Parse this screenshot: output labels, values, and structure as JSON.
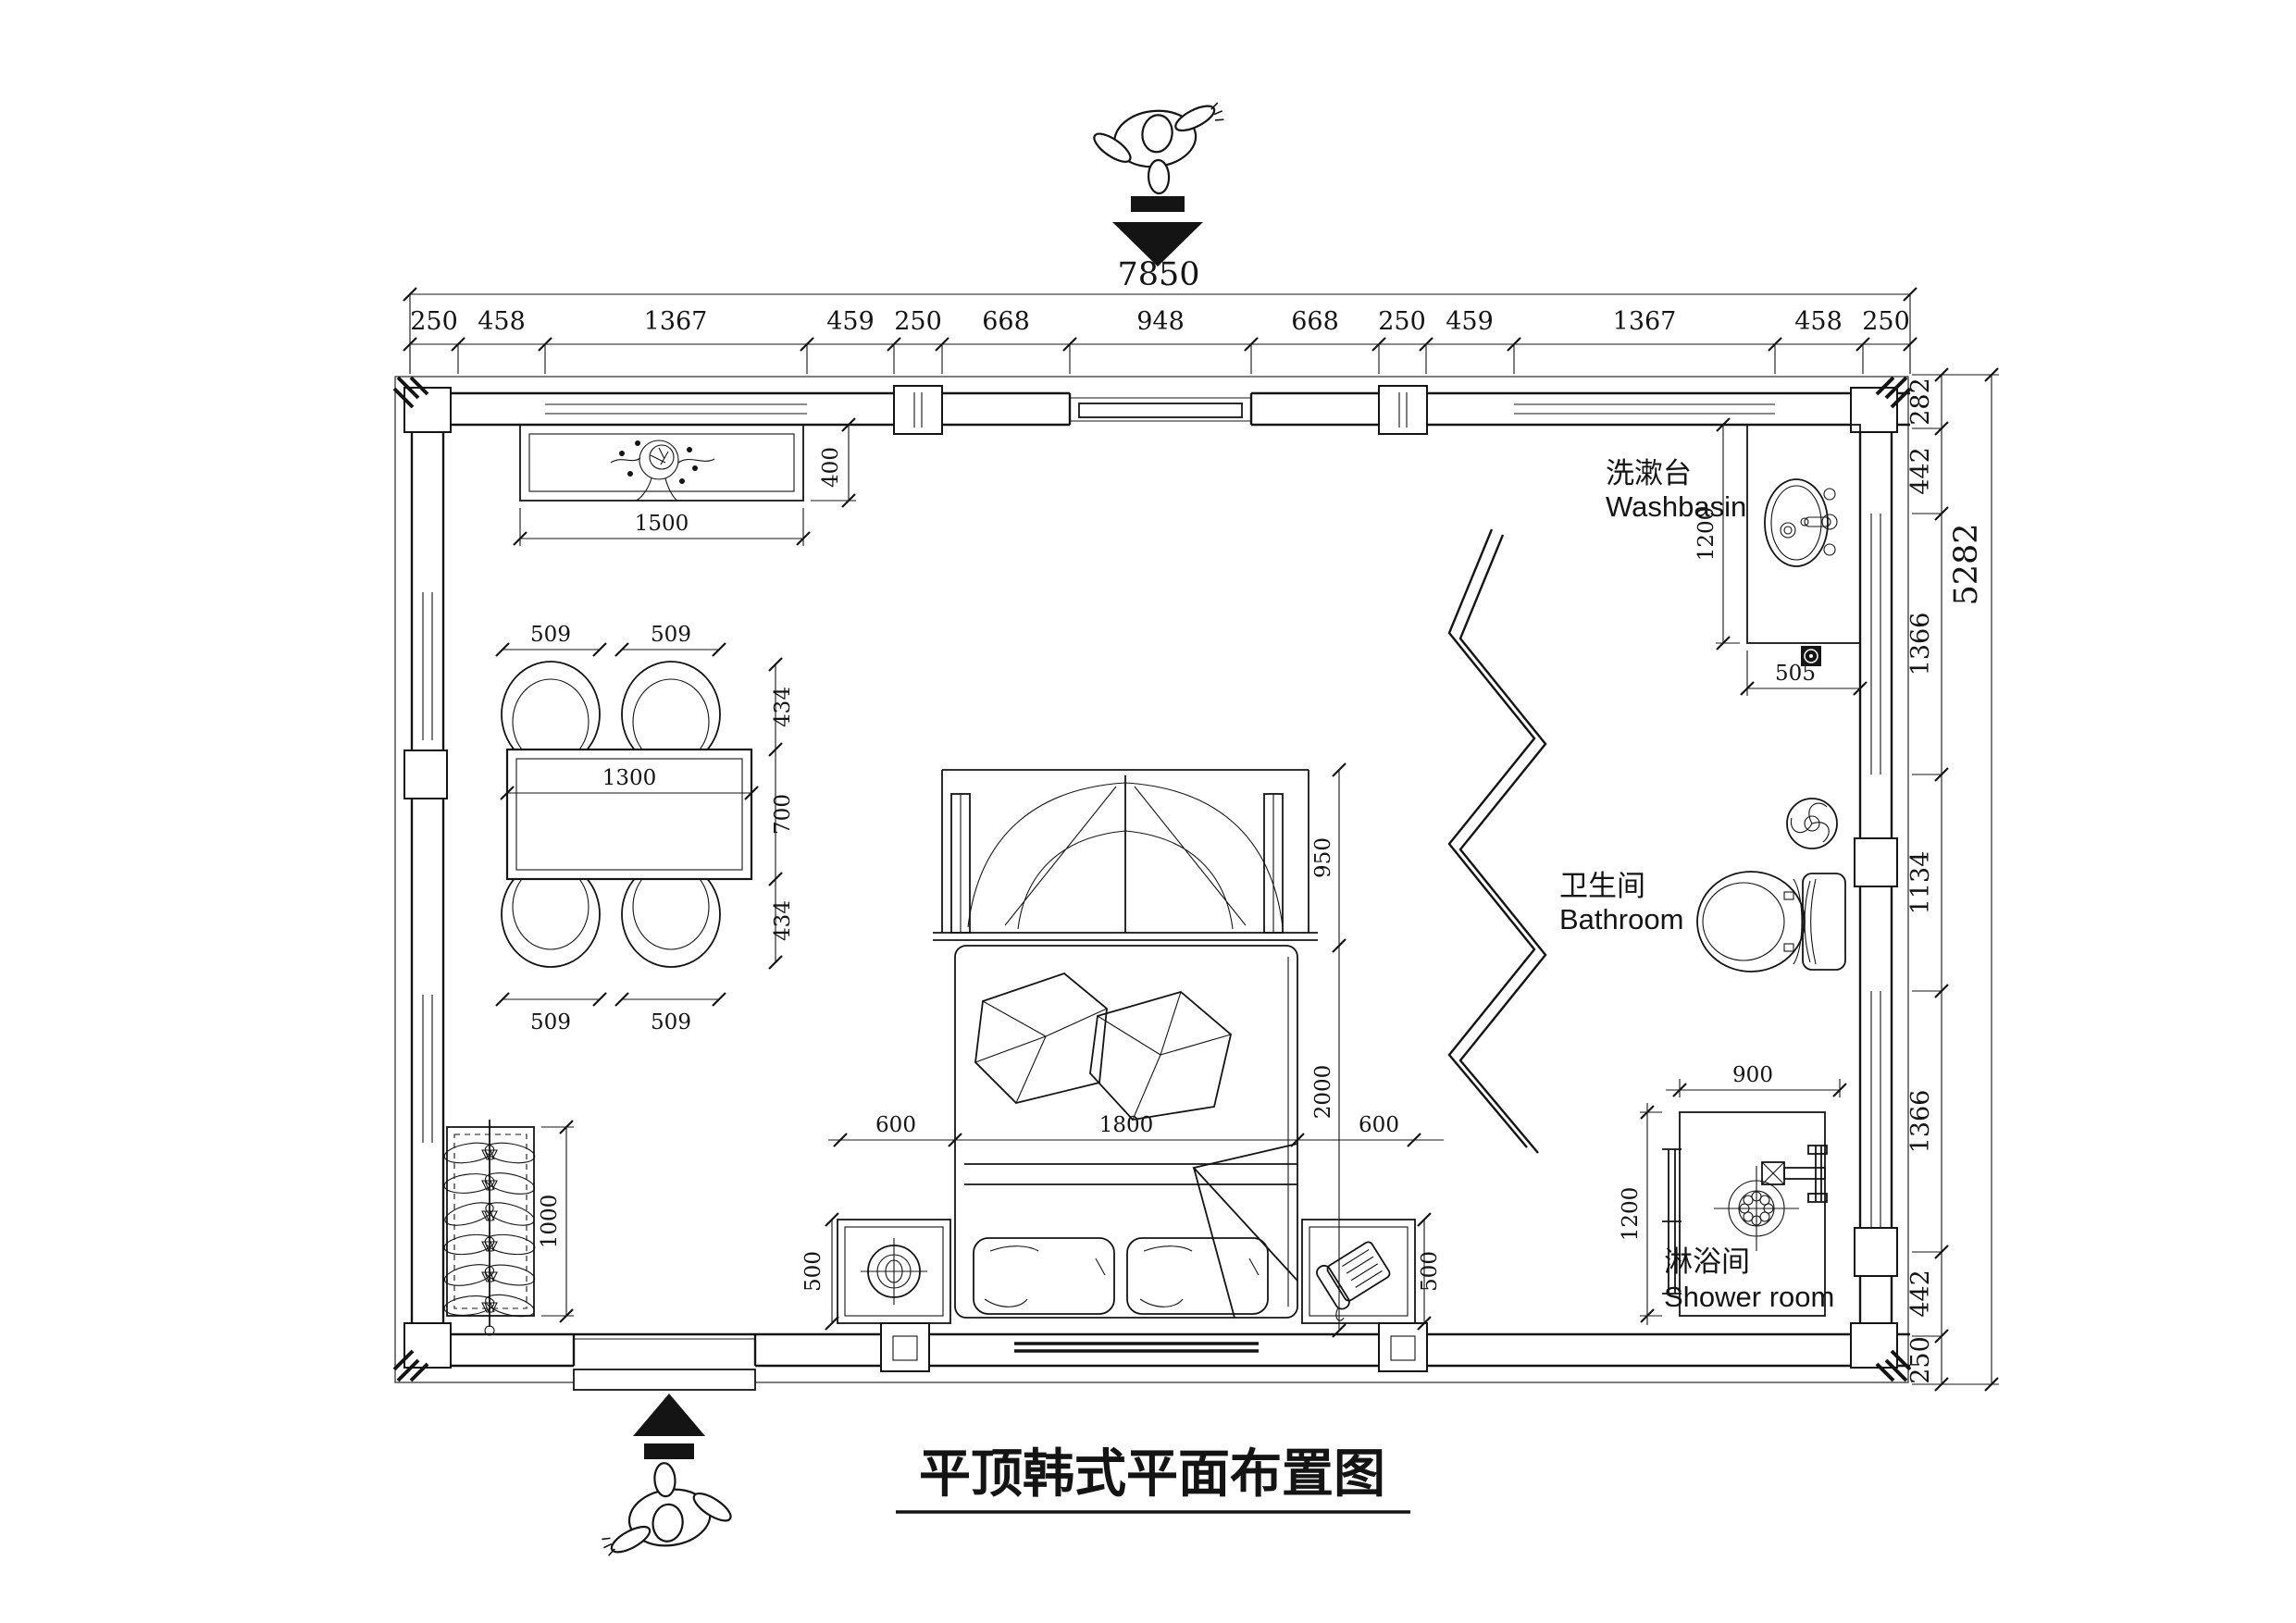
{
  "title": "平顶韩式平面布置图",
  "rooms": {
    "washbasin": {
      "cn": "洗漱台",
      "en": "Washbasin"
    },
    "bathroom": {
      "cn": "卫生间",
      "en": "Bathroom"
    },
    "shower": {
      "cn": "淋浴间",
      "en": "Shower room"
    }
  },
  "dims": {
    "top_total": "7850",
    "top_chain": [
      "250",
      "458",
      "1367",
      "459",
      "250",
      "668",
      "948",
      "668",
      "250",
      "459",
      "1367",
      "458",
      "250"
    ],
    "right_chain": [
      "282",
      "442",
      "1366",
      "1134",
      "1366",
      "442",
      "250"
    ],
    "right_total": "5282",
    "console": {
      "w": "1500",
      "d": "400"
    },
    "table": {
      "w": "1300",
      "d": "700",
      "chair_w": "509",
      "side": "434"
    },
    "bed": {
      "head": "950",
      "side": "600",
      "width": "1800",
      "length": "2000",
      "ns": "500"
    },
    "wardrobe": {
      "h": "1000"
    },
    "washbasin": {
      "h": "1200",
      "w": "505"
    },
    "shower": {
      "w": "900",
      "h": "1200"
    }
  }
}
